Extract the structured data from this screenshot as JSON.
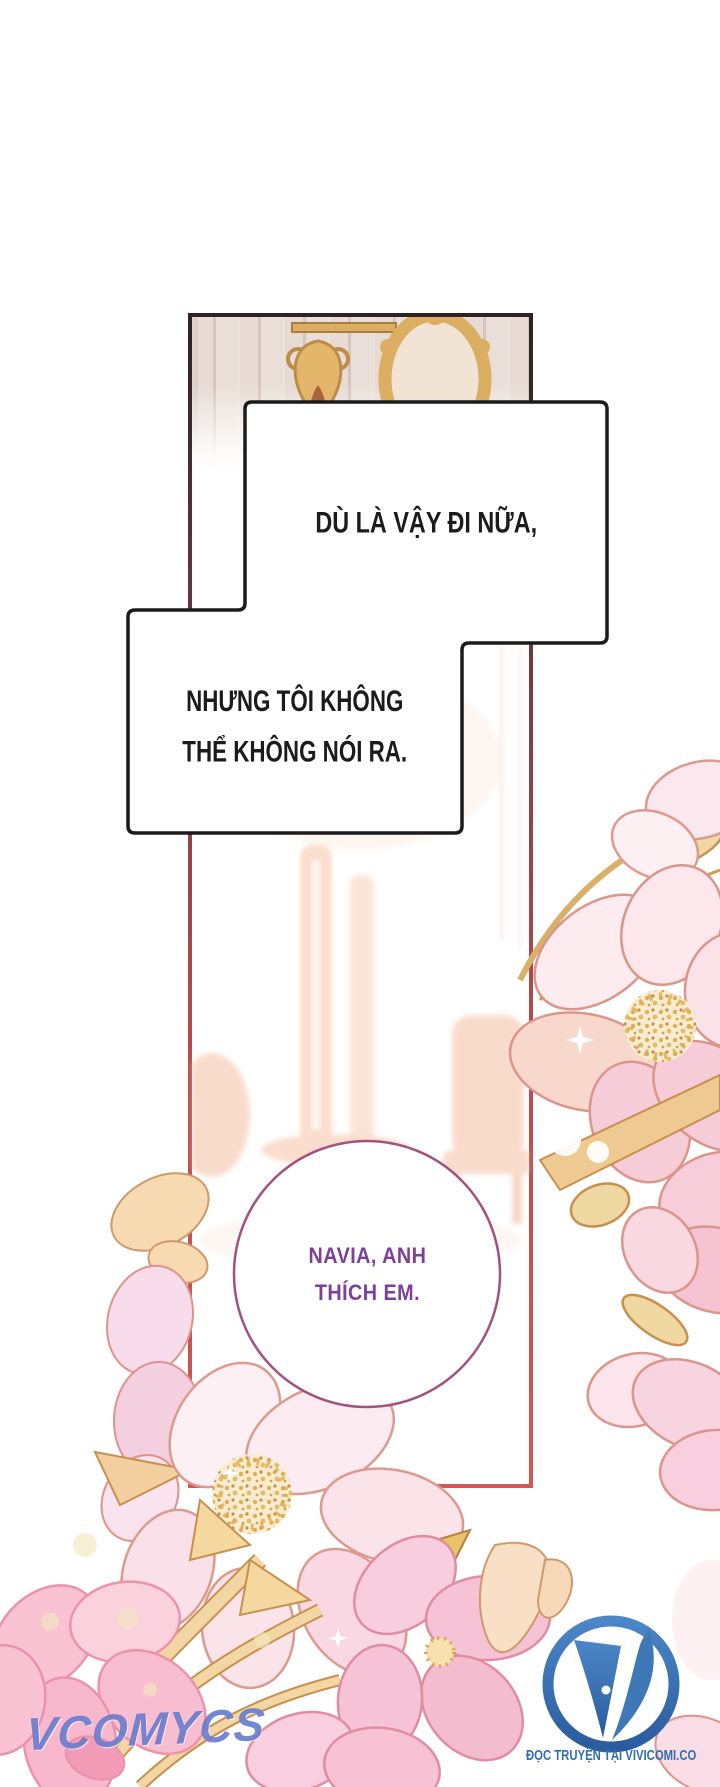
{
  "page": {
    "type": "comic-page",
    "width": 720,
    "height": 1787
  },
  "speech_bubbles": {
    "bubble1": {
      "text": "DÙ LÀ VẬY ĐI NỮA,"
    },
    "bubble2": {
      "line1": "NHƯNG TÔI KHÔNG",
      "line2": "THỂ KHÔNG NÓI RA."
    },
    "circle": {
      "line1": "NAVIA, ANH",
      "line2": "THÍCH EM.",
      "text_color": "#7c3f9a",
      "border_color": "#a3517f"
    }
  },
  "watermark": {
    "text": "VCOMYCS",
    "color": "#5a6fc9"
  },
  "publisher": {
    "caption": "ĐỌC TRUYỆN TẠI VIVICOMI.CO",
    "color": "#2e6db4"
  },
  "colors": {
    "panel_border_top": "#2c2327",
    "panel_border_bottom": "#d25853",
    "bubble_border": "#1b1b1b",
    "wall_cream": "#e9ddd5",
    "frame_gold": "#dcae62",
    "flower_pink_pale": "#fcebf0",
    "flower_pink_deep": "#f6c3d6",
    "flower_peach": "#f7d9b2",
    "flower_outline": "#dd9a8e",
    "leaf_gold": "#f2d49a",
    "leaf_outline": "#c8904e",
    "pollen_gold": "#dcaa4e",
    "logo_blue": "#3570b2"
  }
}
